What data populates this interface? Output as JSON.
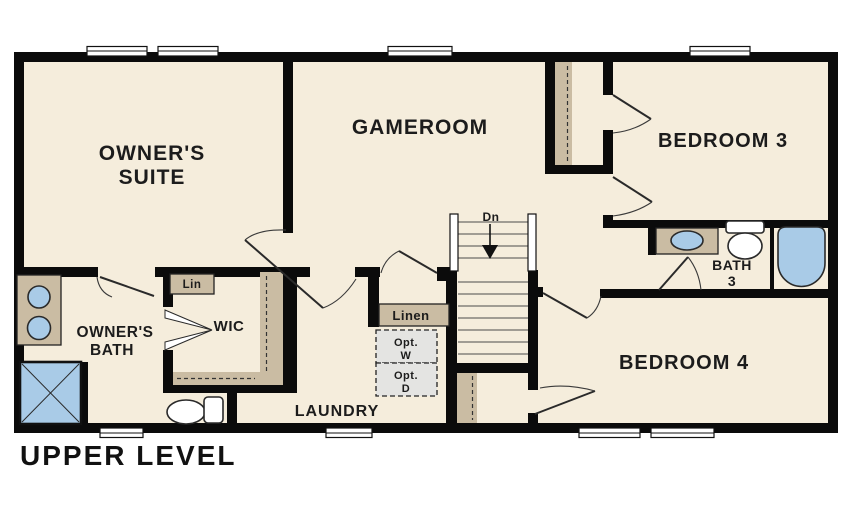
{
  "plan": {
    "title": "UPPER LEVEL",
    "rooms": {
      "owners_suite": {
        "line1": "OWNER'S",
        "line2": "SUITE"
      },
      "gameroom": {
        "label": "GAMEROOM"
      },
      "bedroom3": {
        "label": "BEDROOM 3"
      },
      "bedroom4": {
        "label": "BEDROOM 4"
      },
      "bath3": {
        "line1": "BATH",
        "line2": "3"
      },
      "owners_bath": {
        "line1": "OWNER'S",
        "line2": "BATH"
      },
      "wic": {
        "label": "WIC"
      },
      "laundry": {
        "label": "LAUNDRY"
      },
      "linen_closet": {
        "label": "Linen"
      },
      "linen_shelf": {
        "label": "Lin"
      },
      "opt_washer": {
        "line1": "Opt.",
        "line2": "W"
      },
      "opt_dryer": {
        "line1": "Opt.",
        "line2": "D"
      },
      "stairs": {
        "label": "Dn"
      }
    },
    "fixtures": [
      "double-vanity-sinks",
      "walk-in-shower",
      "toilet",
      "washer-dryer-optional",
      "staircase-down",
      "single-vanity-sink",
      "toilet",
      "bathtub"
    ],
    "colors": {
      "floor": "#f5eddc",
      "wall": "#0b0b0b",
      "casework_tan": "#cabca3",
      "fixture_blue": "#a9cbe7",
      "optional_gray": "#e4e4e2",
      "text": "#1c1c1c"
    }
  }
}
